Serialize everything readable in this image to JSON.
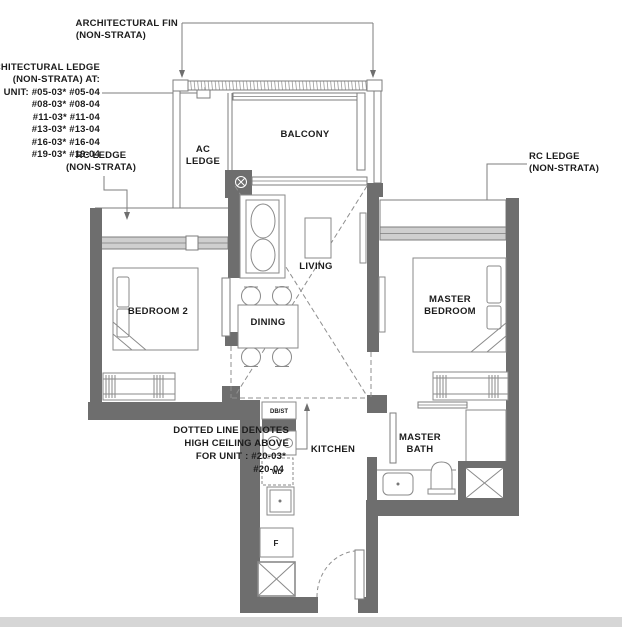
{
  "colors": {
    "wall": "#6e6e6e",
    "line": "#7d7d7d",
    "window_fill": "#cfcfcf",
    "text": "#1c1c1c",
    "page_band": "#d6d6d6"
  },
  "annotations": {
    "fin": {
      "l1": "ARCHITECTURAL FIN",
      "l2": "(NON-STRATA)"
    },
    "arch_ledge": {
      "l1": "ARCHITECTURAL LEDGE",
      "l2": "(NON-STRATA) AT:",
      "l3": "UNIT: #05-03* #05-04",
      "l4": "#08-03* #08-04",
      "l5": "#11-03* #11-04",
      "l6": "#13-03* #13-04",
      "l7": "#16-03* #16-04",
      "l8": "#19-03* #19-04"
    },
    "rc_left": {
      "l1": "RC LEDGE",
      "l2": "(NON-STRATA)"
    },
    "rc_right": {
      "l1": "RC LEDGE",
      "l2": "(NON-STRATA)"
    },
    "note": {
      "l1": "DOTTED LINE DENOTES",
      "l2": "HIGH CEILING ABOVE",
      "l3": "FOR UNIT : #20-03*",
      "l4": "#20-04"
    }
  },
  "rooms": {
    "ac_l1": "AC",
    "ac_l2": "LEDGE",
    "balcony": "BALCONY",
    "living": "LIVING",
    "dining": "DINING",
    "bedroom2": "BEDROOM 2",
    "master_l1": "MASTER",
    "master_l2": "BEDROOM",
    "kitchen": "KITCHEN",
    "bath_l1": "MASTER",
    "bath_l2": "BATH"
  },
  "fixtures": {
    "db_st": "DB/ST",
    "wd": "WD",
    "fridge": "F"
  }
}
